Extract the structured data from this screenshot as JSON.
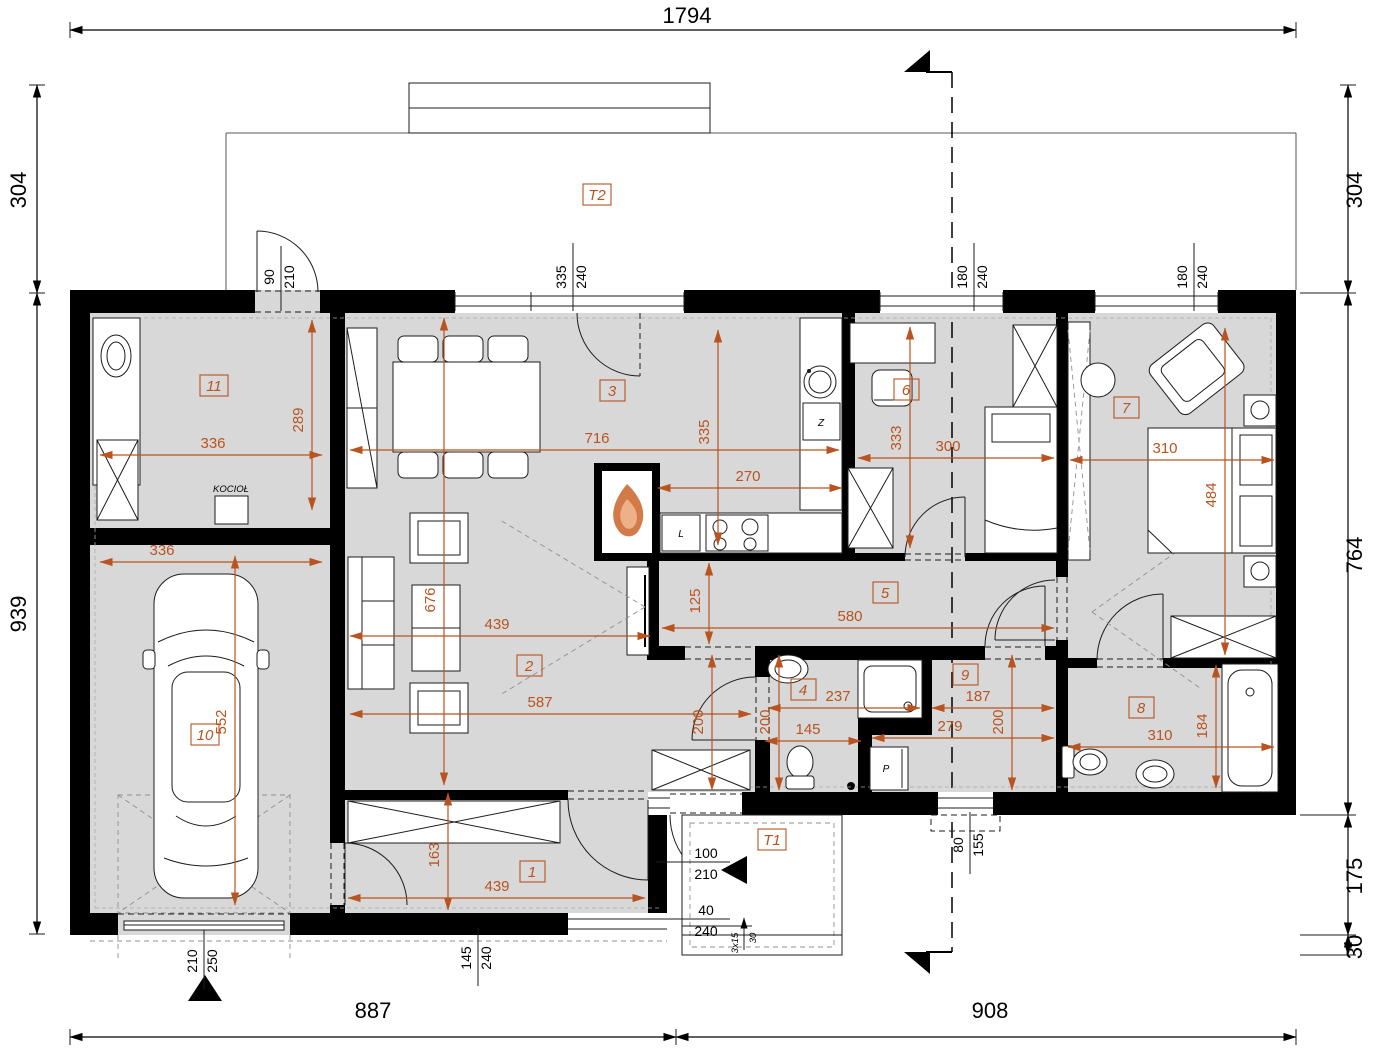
{
  "plan": {
    "scheme": {
      "accent": "#b9531f",
      "wall": "#000000",
      "floor": "#d8d8d8"
    },
    "outer": {
      "top": "1794",
      "left_top": "304",
      "left_main": "939",
      "right_top": "304",
      "right_main": "764",
      "right_porch": "175",
      "right_step": "30",
      "bottom_left": "887",
      "bottom_right": "908"
    },
    "rooms": {
      "r1": "1",
      "r2": "2",
      "r3": "3",
      "r4": "4",
      "r5": "5",
      "r6": "6",
      "r7": "7",
      "r8": "8",
      "r9": "9",
      "r10": "10",
      "r11": "11",
      "t1": "T1",
      "t2": "T2"
    },
    "dims": {
      "r11_w": "336",
      "r11_h": "289",
      "garage_w": "336",
      "garage_h": "552",
      "kitchen_w": "716",
      "kitchen_h": "335",
      "kitchen_counter": "270",
      "living_h": "676",
      "living_w": "439",
      "living_total": "587",
      "hall_h": "163",
      "hall_w": "439",
      "corridor_w": "580",
      "corridor_h": "125",
      "r6_h": "333",
      "r6_w": "300",
      "r7_w": "310",
      "r7_h": "484",
      "vest_h": "200",
      "r4_w": "237",
      "r4_h": "200",
      "r4_lower_w": "145",
      "r9_w": "187",
      "r9_h": "200",
      "r9_lower_w": "279",
      "r8_w": "310",
      "r8_h": "184"
    },
    "openings": {
      "door_utility": {
        "w": "90",
        "h": "210"
      },
      "win_kitchen": {
        "w": "335",
        "h": "240"
      },
      "win_r6": {
        "w": "180",
        "h": "240"
      },
      "win_r7": {
        "w": "180",
        "h": "240"
      },
      "win_r9": {
        "w": "80",
        "h": "155"
      },
      "win_hall": {
        "w": "145",
        "h": "240"
      },
      "door_entry": {
        "w": "100",
        "h": "210"
      },
      "entry_side": {
        "w": "40",
        "h": "240"
      },
      "garage_door": {
        "w": "210",
        "h": "250"
      },
      "steps": "3x15",
      "step_h": "30"
    },
    "labels": {
      "boiler": "KOCIOŁ",
      "sink": "Z",
      "fridge": "L",
      "washer": "P"
    }
  }
}
